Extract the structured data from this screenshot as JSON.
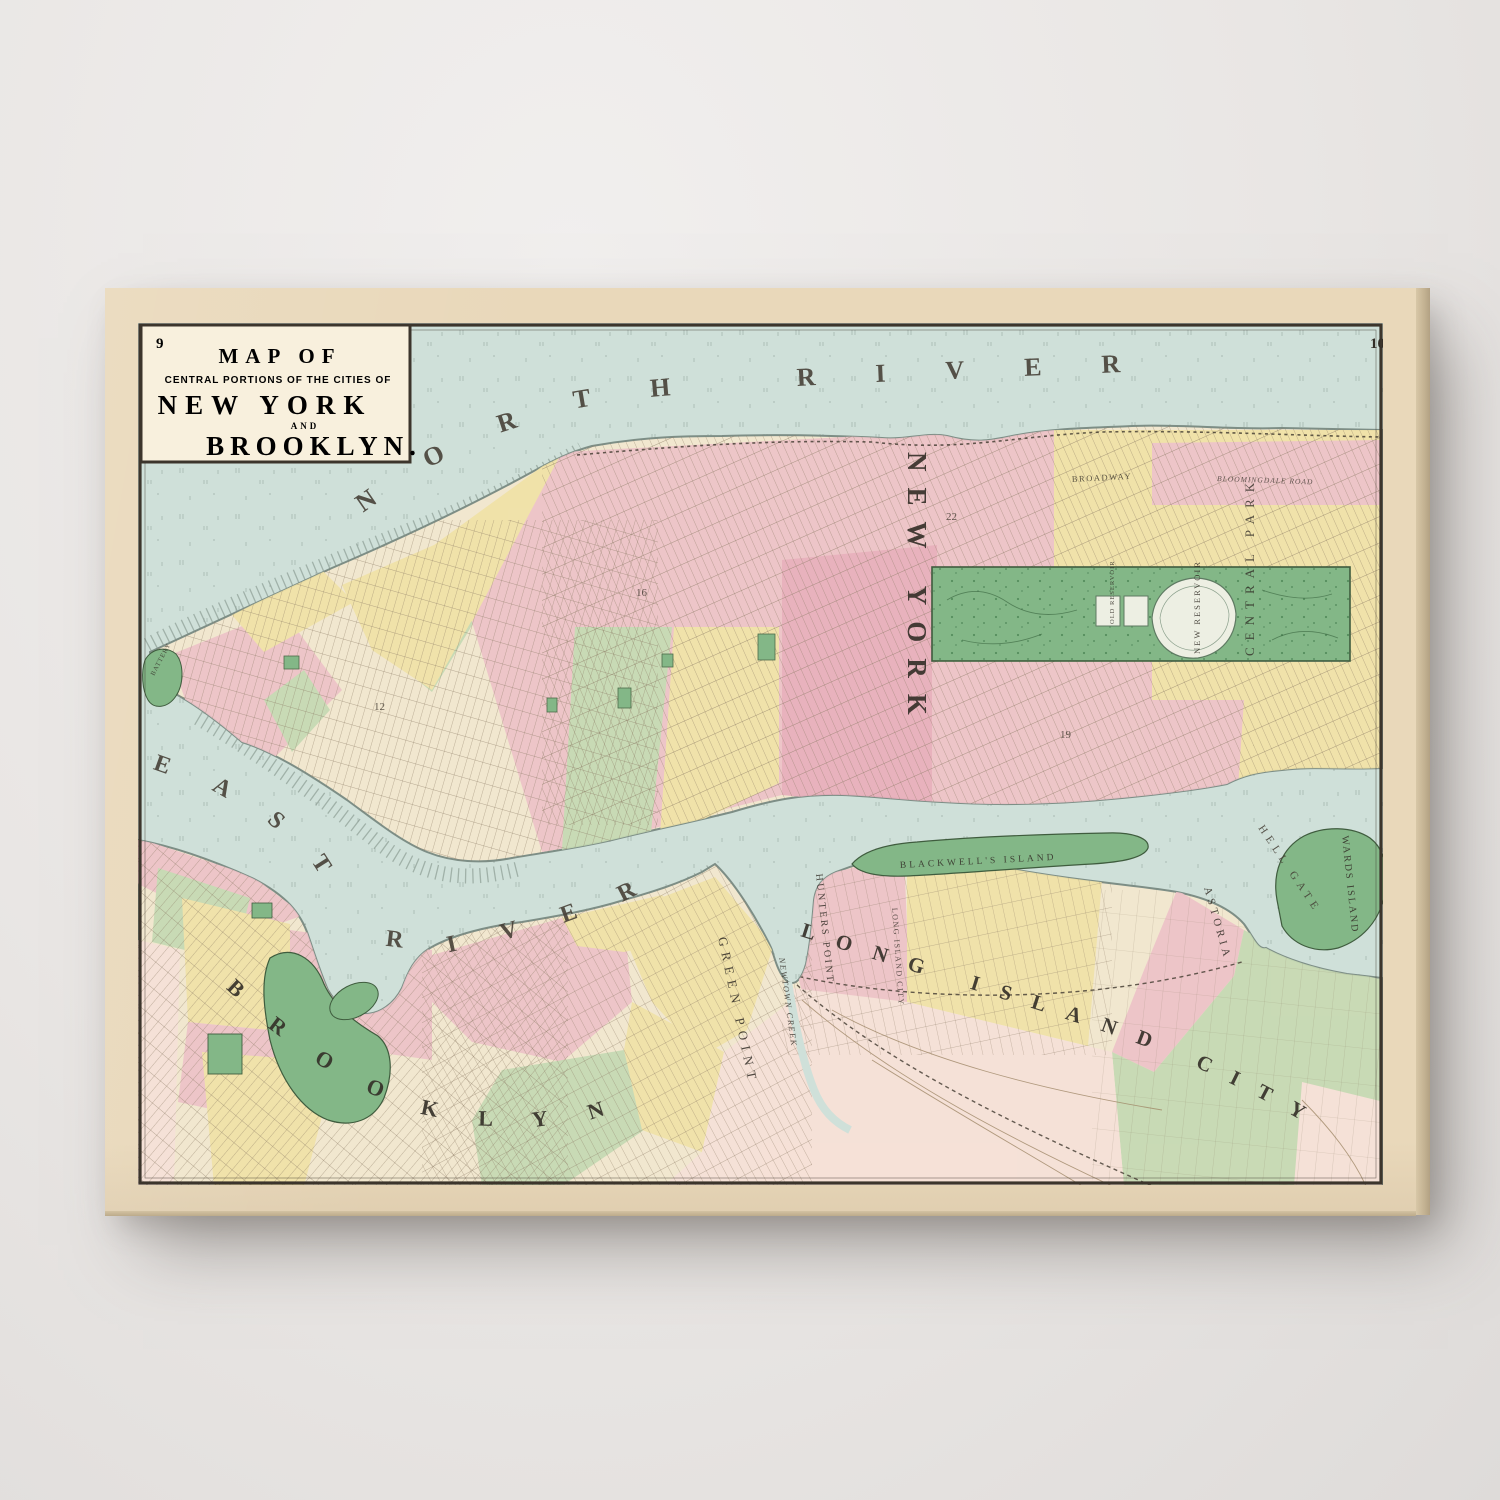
{
  "map": {
    "page_number_left": "9",
    "page_number_right": "10",
    "cartouche": {
      "heading": "MAP OF",
      "subheading": "CENTRAL PORTIONS OF THE CITIES OF",
      "city1": "NEW YORK",
      "conjunction": "AND",
      "city2": "BROOKLYN."
    },
    "labels": {
      "north_river": "NORTH RIVER",
      "east_river": "EAST RIVER",
      "new_york": "NEW YORK",
      "brooklyn": "BROOKLYN",
      "long_island_city": "LONG ISLAND CITY",
      "long_island_city_small": "LONG ISLAND CITY",
      "green_point": "GREEN POINT",
      "hunters_point": "HUNTERS POINT",
      "newtown_creek": "NEWTOWN CREEK",
      "astoria": "ASTORIA",
      "hell_gate": "HELL GATE",
      "wards_island": "WARDS ISLAND",
      "blackwells_island": "BLACKWELL'S ISLAND",
      "central_park": "CENTRAL PARK",
      "new_reservoir": "NEW RESERVOIR",
      "old_reservoir": "OLD RESERVOIR",
      "broadway": "BROADWAY",
      "bloomingdale_road": "BLOOMINGDALE ROAD",
      "battery": "BATTERY"
    },
    "ward_numbers": [
      "22",
      "19",
      "16",
      "12"
    ],
    "colors": {
      "wall": "#e9e6e4",
      "paper": "#e9d8ba",
      "canvas_side": "#d8c7a7",
      "cream": "#f1e7cf",
      "water": "#cfe0d9",
      "ward_pink": "#edc3c8",
      "ward_rose": "#e8aebc",
      "ward_yellow": "#f0e2a7",
      "ward_green": "#c5d9b3",
      "pale_pink": "#f6e1d8",
      "park_green": "#83b787",
      "reservoir": "#edefe3",
      "ink": "#3c352c",
      "shore": "#7d8e86"
    }
  }
}
